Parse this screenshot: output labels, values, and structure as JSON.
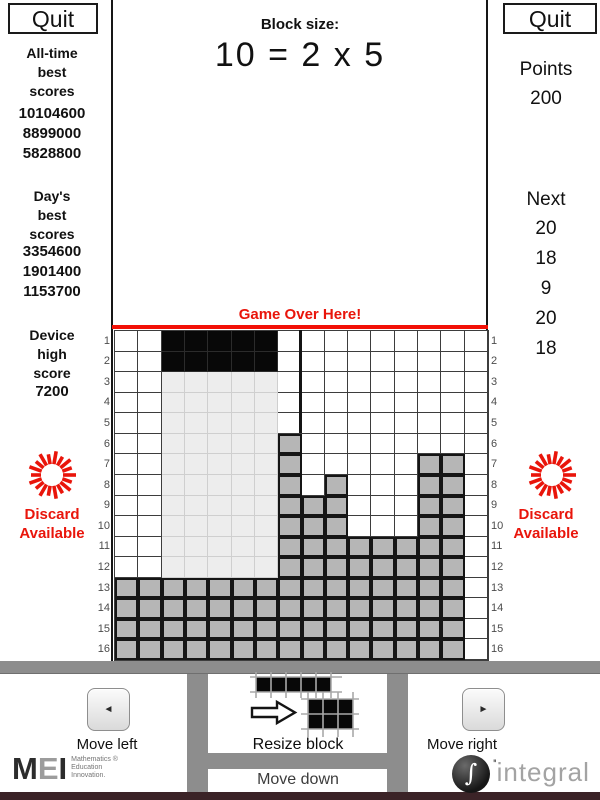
{
  "left_sidebar": {
    "quit_label": "Quit",
    "all_time_header": [
      "All-time",
      "best",
      "scores"
    ],
    "all_time_scores": [
      "10104600",
      "8899000",
      "5828800"
    ],
    "day_header": [
      "Day's",
      "best",
      "scores"
    ],
    "day_scores": [
      "3354600",
      "1901400",
      "1153700"
    ],
    "device_header": [
      "Device",
      "high",
      "score"
    ],
    "device_score": "7200",
    "discard_line1": "Discard",
    "discard_line2": "Available"
  },
  "right_sidebar": {
    "quit_label": "Quit",
    "points_label": "Points",
    "points_value": "200",
    "next_label": "Next",
    "next_values": [
      "20",
      "18",
      "9",
      "20",
      "18"
    ],
    "discard_line1": "Discard",
    "discard_line2": "Available"
  },
  "header": {
    "block_size_label": "Block size:",
    "block_size_equation": "10 = 2 x 5"
  },
  "game": {
    "game_over_label": "Game Over Here!",
    "row_labels": [
      "1",
      "2",
      "3",
      "4",
      "5",
      "6",
      "7",
      "8",
      "9",
      "10",
      "11",
      "12",
      "13",
      "14",
      "15",
      "16"
    ],
    "grid_cols": 16,
    "grid_rows": 16,
    "cell_codes": {
      ".": "empty",
      "B": "falling-block-black",
      "L": "drop-trail-lightgray",
      "G": "settled-gray"
    },
    "rows": [
      "..BBBBB.........",
      "..BBBBB.........",
      "..LLLLL.........",
      "..LLLLL.........",
      "..LLLLL.........",
      "..LLLLLG........",
      "..LLLLLG.....GG.",
      "..LLLLLG.G...GG.",
      "..LLLLLGGG...GG.",
      "..LLLLLGGG...GG.",
      "..LLLLLGGGGGGGG.",
      "..LLLLLGGGGGGGG.",
      "GGGGGGGGGGGGGGG.",
      "GGGGGGGGGGGGGGG.",
      "GGGGGGGGGGGGGGG.",
      "GGGGGGGGGGGGGGG."
    ]
  },
  "controls": {
    "move_left_label": "Move left",
    "move_right_label": "Move right",
    "move_down_label": "Move down",
    "resize_label": "Resize block",
    "move_left_glyph": "◄",
    "move_right_glyph": "►"
  },
  "branding": {
    "mei_letters": {
      "m": "M",
      "e": "E",
      "i": "I"
    },
    "mei_lines": [
      "Mathematics ®",
      "Education",
      "Innovation."
    ],
    "integral_prefix": "''",
    "integral_glyph": "∫",
    "integral_text": "integral"
  },
  "icons": {
    "discard": "red-starburst-icon",
    "move_left": "left-triangle-icon",
    "move_right": "right-triangle-icon",
    "resize": "block-resize-arrow-icon",
    "integral": "integral-sphere-icon"
  },
  "colors": {
    "red": "#e9150b",
    "settled_gray": "#b6b6b6",
    "trail_gray": "#ededed",
    "bar_gray": "#8d8d8d",
    "bottom_strip": "#3b2327",
    "block_black": "#080808"
  }
}
